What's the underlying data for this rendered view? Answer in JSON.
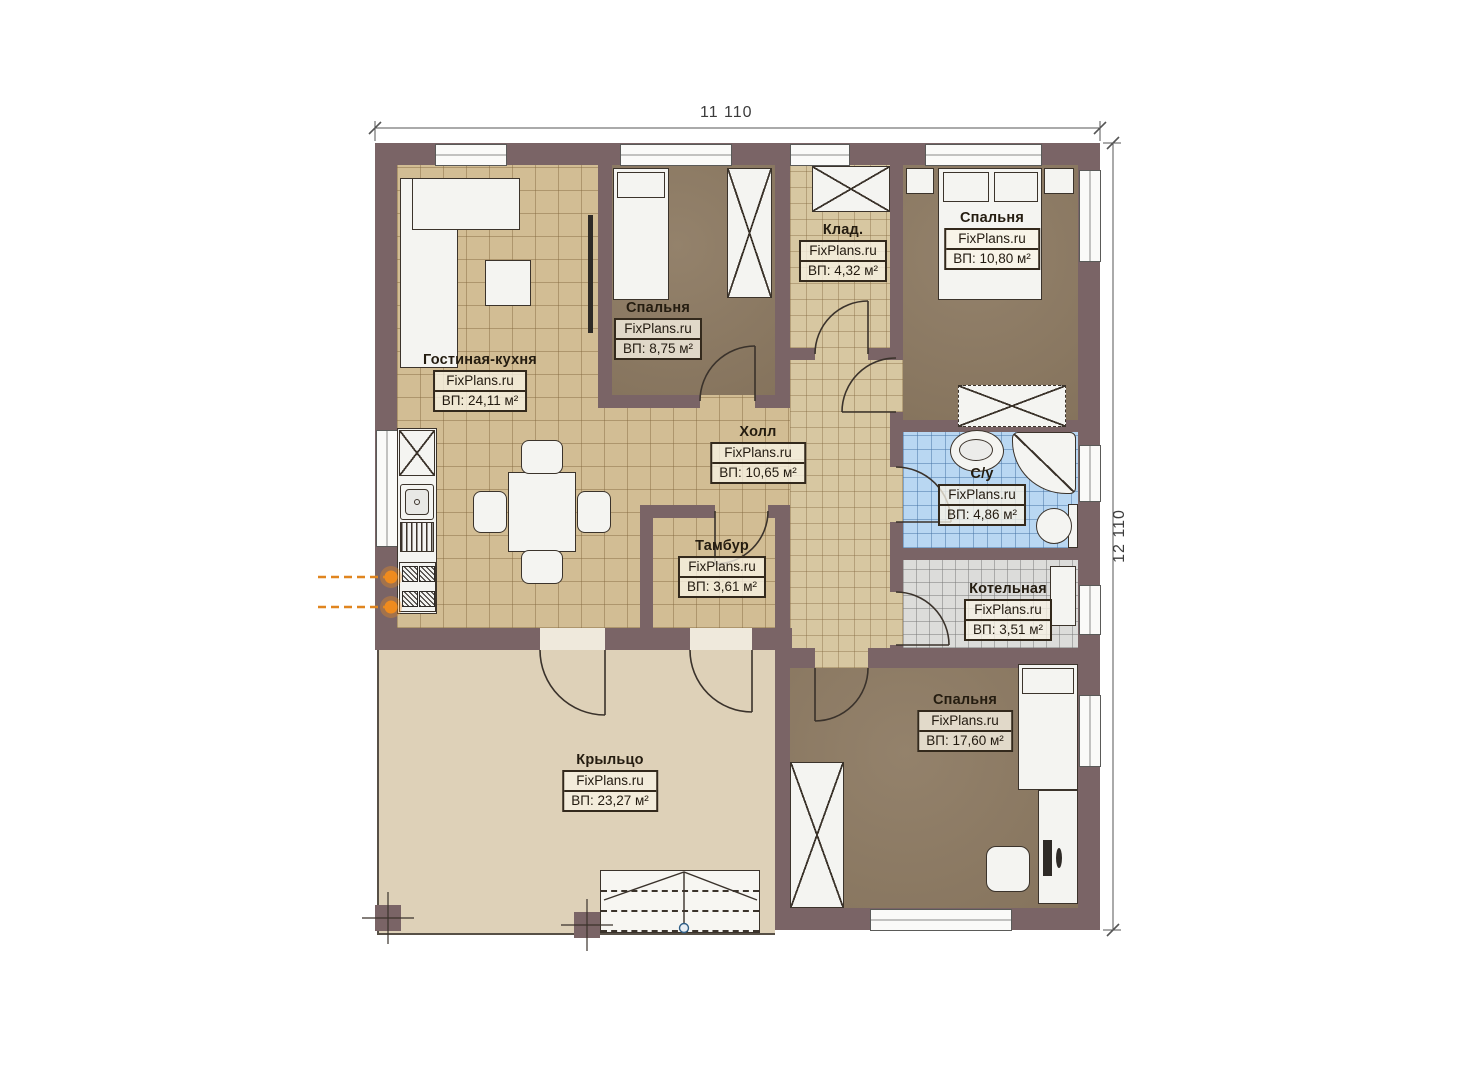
{
  "plan": {
    "title": "Floor plan",
    "dimensions": {
      "width_label": "11 110",
      "height_label": "12 110"
    },
    "watermark": "FixPlans.ru",
    "colors": {
      "wall": "#7a6466",
      "tile_beige": "#d2bd94",
      "floor_brown": "#8d7a62",
      "tile_blue": "#b9d7f2",
      "tile_gray": "#dcdcda",
      "porch": "#ded1b8",
      "gas_marker": "#ef8b1e"
    },
    "rooms": [
      {
        "id": "living-kitchen",
        "name": "Гостиная-кухня",
        "watermark": "FixPlans.ru",
        "area": "ВП: 24,11 м²"
      },
      {
        "id": "bedroom-1",
        "name": "Спальня",
        "watermark": "FixPlans.ru",
        "area": "ВП: 8,75 м²"
      },
      {
        "id": "storage",
        "name": "Клад.",
        "watermark": "FixPlans.ru",
        "area": "ВП: 4,32 м²"
      },
      {
        "id": "bedroom-2",
        "name": "Спальня",
        "watermark": "FixPlans.ru",
        "area": "ВП: 10,80 м²"
      },
      {
        "id": "hall",
        "name": "Холл",
        "watermark": "FixPlans.ru",
        "area": "ВП: 10,65 м²"
      },
      {
        "id": "bathroom",
        "name": "С/у",
        "watermark": "FixPlans.ru",
        "area": "ВП: 4,86 м²"
      },
      {
        "id": "tambour",
        "name": "Тамбур",
        "watermark": "FixPlans.ru",
        "area": "ВП: 3,61 м²"
      },
      {
        "id": "boiler-room",
        "name": "Котельная",
        "watermark": "FixPlans.ru",
        "area": "ВП: 3,51 м²"
      },
      {
        "id": "bedroom-3",
        "name": "Спальня",
        "watermark": "FixPlans.ru",
        "area": "ВП: 17,60 м²"
      },
      {
        "id": "porch",
        "name": "Крыльцо",
        "watermark": "FixPlans.ru",
        "area": "ВП: 23,27 м²"
      }
    ]
  }
}
